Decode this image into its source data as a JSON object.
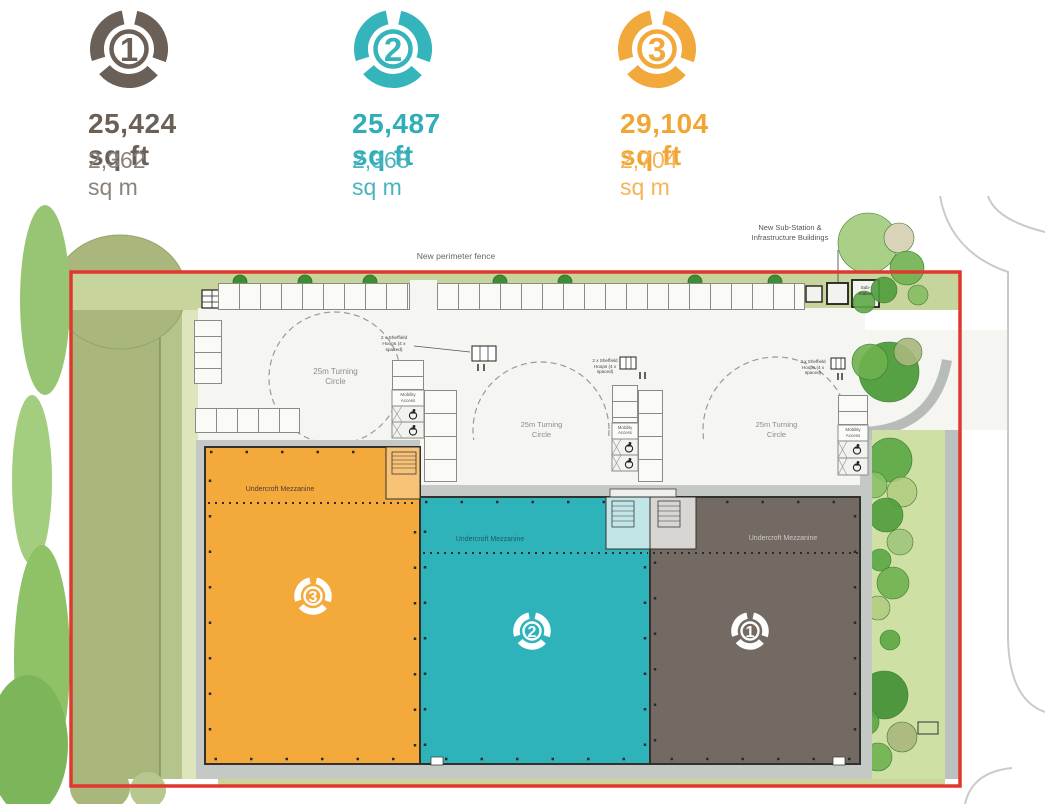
{
  "header": {
    "units": [
      {
        "number": "1",
        "sqft": "25,424 sq ft",
        "sqm": "2,362 sq m"
      },
      {
        "number": "2",
        "sqft": "25,487 sq ft",
        "sqm": "2,368 sq m"
      },
      {
        "number": "3",
        "sqft": "29,104 sq ft",
        "sqm": "2,704 sq m"
      }
    ]
  },
  "plan": {
    "perimeter_fence_label": "New perimeter fence",
    "substation_label_line1": "New Sub-Station &",
    "substation_label_line2": "Infrastructure Buildings",
    "substation_box_line1": "Sub-",
    "substation_box_line2": "Station",
    "turning_circle_line1": "25m Turning",
    "turning_circle_line2": "Circle",
    "hoops_line1": "2 x Sheffield",
    "hoops_line2": "Hoops (4 x",
    "hoops_line3": "spaced)",
    "mobility_line1": "Mobility",
    "mobility_line2": "Access",
    "mezzanine_label": "Undercroft Mezzanine",
    "unit_badges": {
      "unit1": "1",
      "unit2": "2",
      "unit3": "3"
    }
  },
  "colors": {
    "unit1_accent": "#6A6058",
    "unit1_light": "#8A827B",
    "unit1_building": "#746A64",
    "unit2_accent": "#2FAEB9",
    "unit2_light": "#4AB4BE",
    "unit2_building": "#2FB3BB",
    "unit3_accent": "#F0A635",
    "unit3_light": "#F4B458",
    "unit3_building": "#F4A93B",
    "boundary_red": "#E0382E",
    "landscape_green": "#A9B77D",
    "verge_green": "#CFE0A4"
  }
}
